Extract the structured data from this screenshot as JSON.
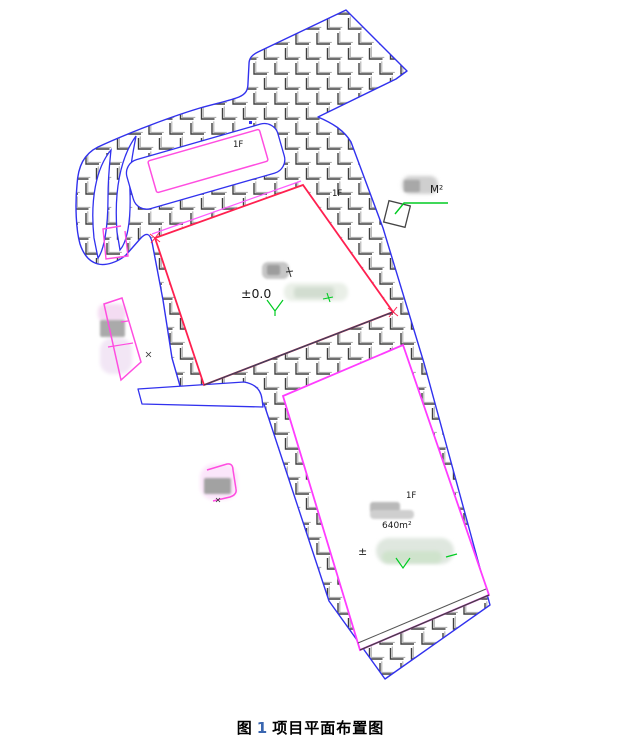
{
  "figure": {
    "type": "site-plan-drawing",
    "caption": {
      "prefix": "图",
      "number": "1",
      "title": "项目平面布置图"
    },
    "labels": {
      "annex_floor": "1F",
      "building_a_floor": "1F",
      "building_a_elevation": "±0.0",
      "area_callout_unit": "M²",
      "building_b_floor": "1F",
      "building_b_area": "640m²",
      "building_b_elevation_prefix": "±"
    },
    "colors": {
      "site_boundary": "#3131ee",
      "building_a_outline": "#ff2050",
      "building_b_outline": "#ff3cff",
      "annex_outline": "#ff4de0",
      "leader_green": "#00cc22",
      "hatch_dark": "#3f3f3f",
      "hatch_light": "#b0b0b0",
      "caption_number": "#3a66b0"
    }
  }
}
